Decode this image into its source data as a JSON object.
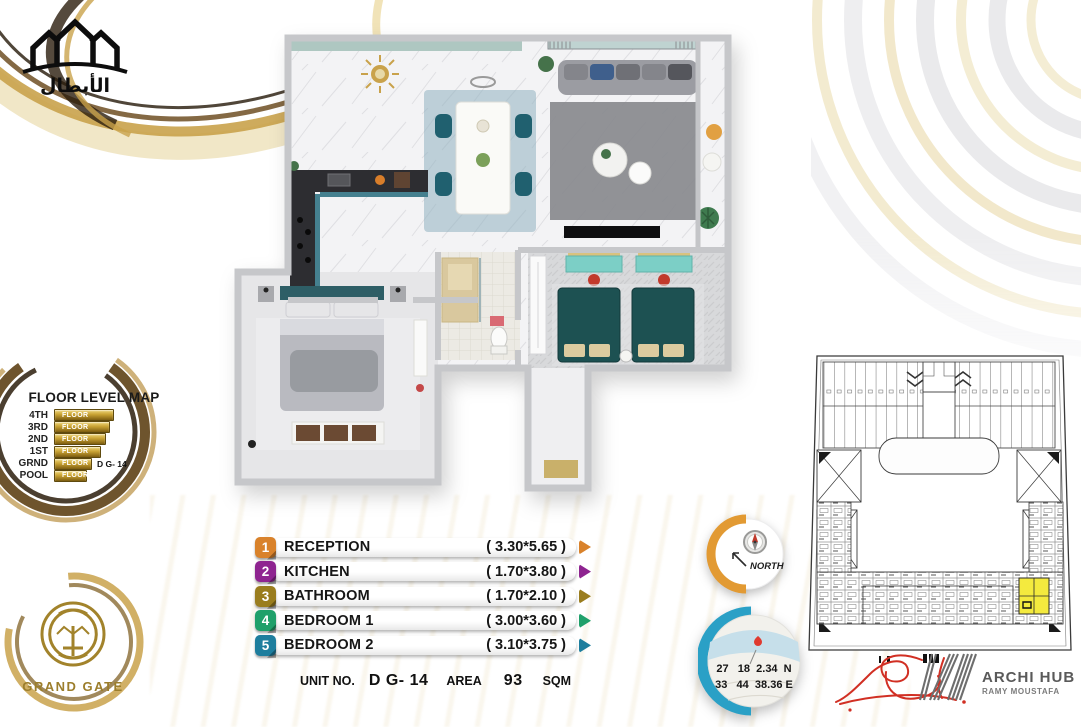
{
  "header_logo": {
    "name_ar": "الأبطال"
  },
  "floor_level_map": {
    "title": "FLOOR LEVEL MAP",
    "levels": [
      {
        "label": "4TH",
        "bar_text": "FLOOR",
        "width_px": 58
      },
      {
        "label": "3RD",
        "bar_text": "FLOOR",
        "width_px": 54
      },
      {
        "label": "2ND",
        "bar_text": "FLOOR",
        "width_px": 50
      },
      {
        "label": "1ST",
        "bar_text": "FLOOR",
        "width_px": 45
      },
      {
        "label": "GRND",
        "bar_text": "FLOOR",
        "width_px": 36,
        "note": "D G- 14"
      },
      {
        "label": "POOL",
        "bar_text": "FLOOR",
        "width_px": 31
      }
    ]
  },
  "legend": {
    "rooms": [
      {
        "num": "1",
        "name": "RECEPTION",
        "dims": "( 3.30*5.65 )",
        "color": "#D9822B"
      },
      {
        "num": "2",
        "name": "KITCHEN",
        "dims": "( 1.70*3.80 )",
        "color": "#8E2490"
      },
      {
        "num": "3",
        "name": "BATHROOM",
        "dims": "( 1.70*2.10 )",
        "color": "#9A7D1E"
      },
      {
        "num": "4",
        "name": "BEDROOM 1",
        "dims": "( 3.00*3.60 )",
        "color": "#1FA06A"
      },
      {
        "num": "5",
        "name": "BEDROOM 2",
        "dims": "( 3.10*3.75 )",
        "color": "#1E7E9E"
      }
    ]
  },
  "unit_info": {
    "unit_no_label": "UNIT NO.",
    "unit_no": "D G- 14",
    "area_label": "AREA",
    "area_value": "93",
    "area_unit": "SQM"
  },
  "compass": {
    "label": "NORTH"
  },
  "location": {
    "lat": "27   18  2.34  N",
    "lng": "33   44  38.36 E"
  },
  "footer": {
    "architect_logo": "ARCHI HUB",
    "architect_sub": "RAMY MOUSTAFA",
    "developer": "GRAND GATE"
  },
  "colors": {
    "highlight_unit": "#F4EA3E",
    "gold": "#C9A233",
    "orange_ring": "#E29A33",
    "teal_ring": "#2AA0C6"
  }
}
